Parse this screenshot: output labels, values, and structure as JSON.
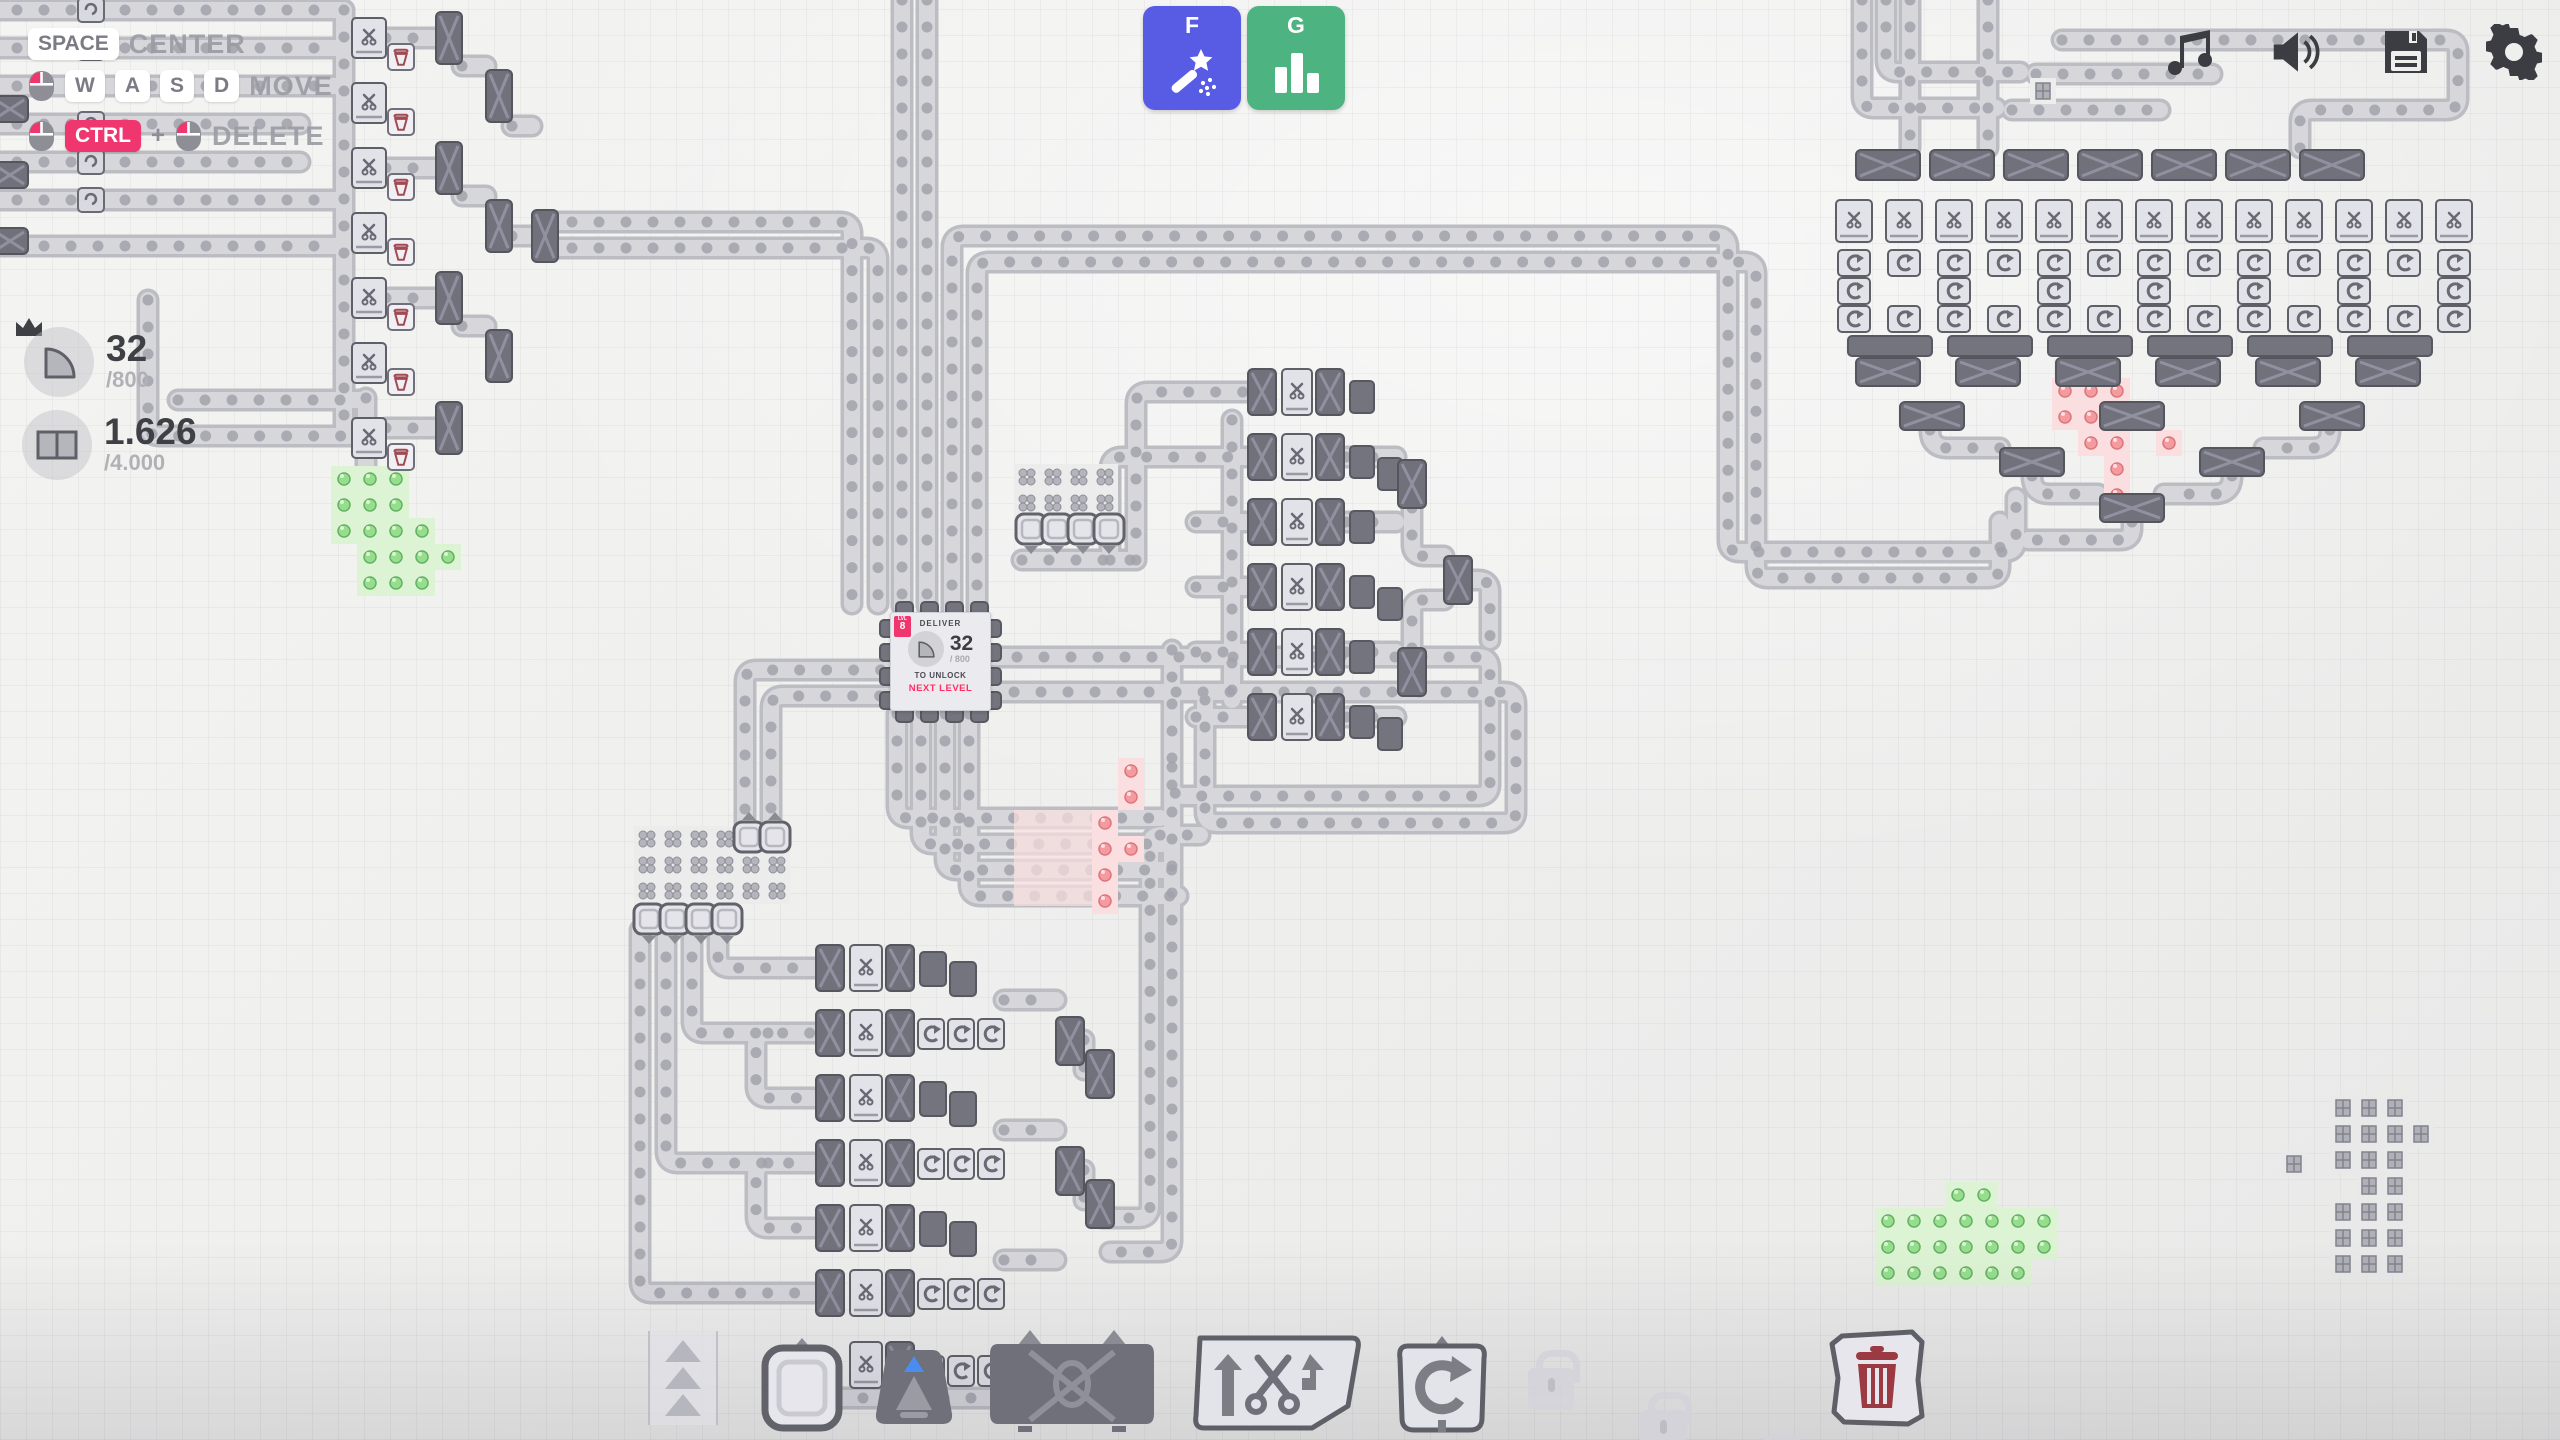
{
  "meta": {
    "game": "shapez-factory",
    "view": "map"
  },
  "colors": {
    "accent_pink": "#f0366e",
    "button_f_bg": "#585ce5",
    "button_g_bg": "#4db381",
    "system_icon": "#3c3c43",
    "belt": "#c6c6cc",
    "machine_dark": "#71717b",
    "machine_light": "#e2e2e9",
    "patch_green": "#8fd98a",
    "patch_red": "#f59a9e",
    "next_level_red": "#ff2e63"
  },
  "keybinds": {
    "center": {
      "key": "SPACE",
      "label": "CENTER"
    },
    "move": {
      "keys": {
        "k0": "W",
        "k1": "A",
        "k2": "S",
        "k3": "D"
      },
      "label": "MOVE"
    },
    "delete": {
      "key": "CTRL",
      "plus": "+",
      "label": "DELETE"
    }
  },
  "goals": {
    "items": {
      "g0": {
        "shape": "quarter-circle-shape",
        "amount": "32",
        "target": "/800"
      },
      "g1": {
        "shape": "double-rect-shape",
        "amount": "1.626",
        "target": "/4.000"
      }
    }
  },
  "quick_buttons": {
    "f": {
      "key": "F",
      "icon": "magic-wand-icon"
    },
    "g": {
      "key": "G",
      "icon": "bar-chart-icon"
    }
  },
  "system_icons": {
    "list": "music-icon, volume-icon, save-icon, settings-icon"
  },
  "hub": {
    "badge_prefix": "LVL",
    "badge_level": "8",
    "deliver_label": "DELIVER",
    "shape": "quarter-circle-shape",
    "amount": "32",
    "target": "/ 800",
    "unlock_label": "TO UNLOCK",
    "next_level_label": "NEXT LEVEL"
  },
  "toolbar": {
    "belt": {
      "name": "belt"
    },
    "extractor": {
      "name": "extractor"
    },
    "tunnel": {
      "name": "tunnel"
    },
    "balancer": {
      "name": "balancer"
    },
    "cutter": {
      "name": "cutter"
    },
    "rotator": {
      "name": "rotator"
    },
    "locked_1": {
      "name": "locked-slot"
    },
    "locked_2": {
      "name": "locked-slot"
    },
    "locked_3": {
      "name": "locked-slot"
    },
    "trash": {
      "name": "trash"
    }
  }
}
